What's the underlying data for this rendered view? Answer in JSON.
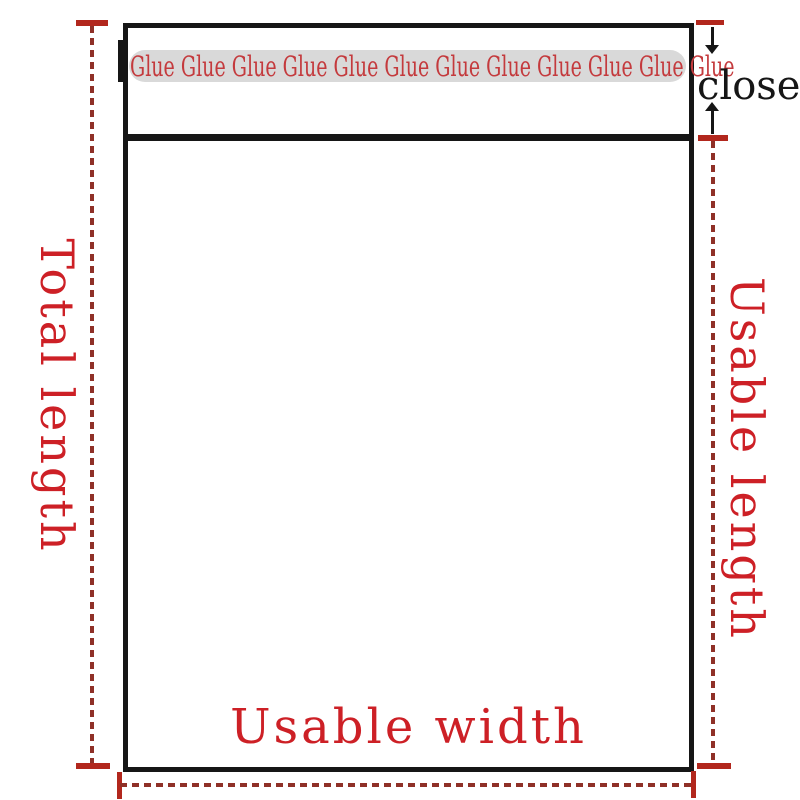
{
  "diagram": {
    "type": "packaging-bag-dimension-diagram",
    "labels": {
      "total_length": "Total length",
      "usable_length": "Usable length",
      "usable_width": "Usable width",
      "close": "close"
    },
    "glue_strip": {
      "word": "Glue",
      "repeat": 12,
      "text": "Glue Glue Glue Glue Glue Glue Glue Glue Glue Glue Glue Glue"
    }
  },
  "colors": {
    "red_text": "#cd2026",
    "glue_text": "#c43a3d",
    "dash": "#8f3027",
    "tick": "#b2271d",
    "ink": "#161616",
    "strip": "#d9d9d9",
    "paper": "#ffffff"
  }
}
